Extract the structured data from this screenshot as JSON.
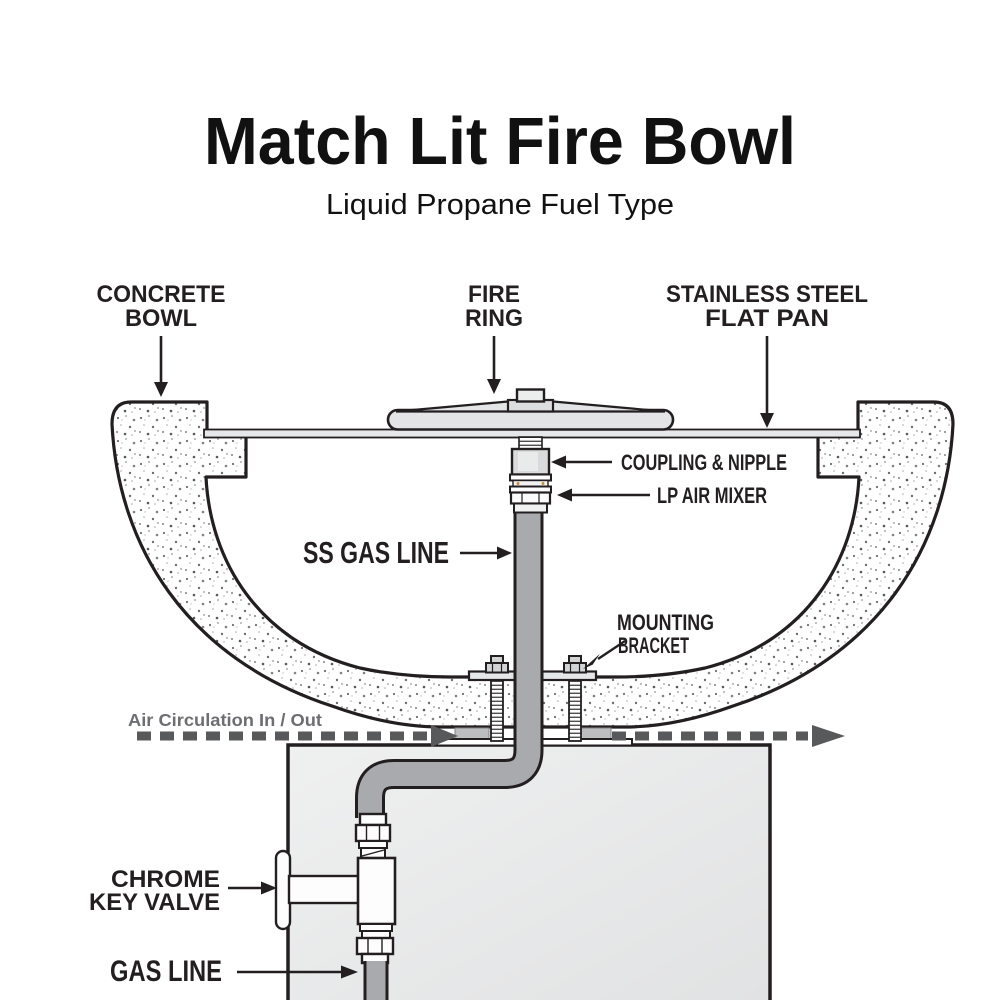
{
  "header": {
    "title": "Match Lit Fire Bowl",
    "subtitle": "Liquid Propane Fuel Type"
  },
  "labels": {
    "concrete_bowl": {
      "line1": "CONCRETE",
      "line2": "BOWL"
    },
    "fire_ring": {
      "line1": "FIRE",
      "line2": "RING"
    },
    "flat_pan": {
      "line1": "STAINLESS STEEL",
      "line2": "FLAT PAN"
    },
    "coupling_nipple": "COUPLING & NIPPLE",
    "lp_air_mixer": "LP AIR MIXER",
    "ss_gas_line": "SS GAS LINE",
    "mounting_bracket": {
      "line1": "MOUNTING",
      "line2": "BRACKET"
    },
    "air_circulation": "Air Circulation In / Out",
    "chrome_key_valve": {
      "line1": "CHROME",
      "line2": "KEY VALVE"
    },
    "gas_line": "GAS LINE"
  },
  "colors": {
    "label": "#231f20",
    "muted_gray": "#6d6e71",
    "dash_gray": "#58595b",
    "pipe_gray": "#a8aaad",
    "metal_light": "#e6e7e8",
    "brass_dot": "#c98f2e",
    "background": "#ffffff"
  }
}
